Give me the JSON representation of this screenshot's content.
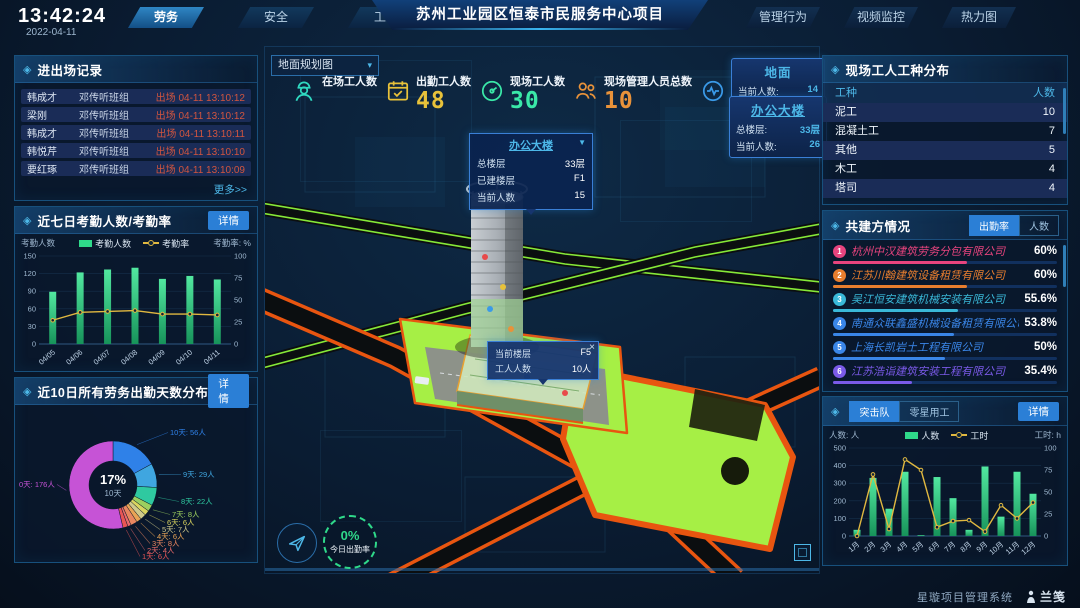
{
  "header": {
    "time": "13:42:24",
    "date": "2022-04-11",
    "tabs_left": [
      {
        "label": "劳务",
        "active": true
      },
      {
        "label": "安全",
        "active": false
      },
      {
        "label": "工期",
        "active": false
      }
    ],
    "title": "苏州工业园区恒泰市民服务中心项目",
    "tabs_right": [
      "管理行为",
      "视频监控",
      "热力图"
    ]
  },
  "entry_exit": {
    "title": "进出场记录",
    "more": "更多>>",
    "rows": [
      {
        "name": "韩成才",
        "team": "邓传听班组",
        "event": "出场 04-11 13:10:12"
      },
      {
        "name": "梁刚",
        "team": "邓传听班组",
        "event": "出场 04-11 13:10:12"
      },
      {
        "name": "韩成才",
        "team": "邓传听班组",
        "event": "出场 04-11 13:10:11"
      },
      {
        "name": "韩悦芹",
        "team": "邓传听班组",
        "event": "出场 04-11 13:10:10"
      },
      {
        "name": "要红琢",
        "team": "邓传听班组",
        "event": "出场 04-11 13:10:09"
      }
    ]
  },
  "panels": {
    "attendance_detail": "详情",
    "distribution_detail": "详情"
  },
  "worker_types": {
    "title": "现场工人工种分布",
    "columns": [
      "工种",
      "人数"
    ],
    "rows": [
      [
        "泥工",
        "10"
      ],
      [
        "混凝土工",
        "7"
      ],
      [
        "其他",
        "5"
      ],
      [
        "木工",
        "4"
      ],
      [
        "塔司",
        "4"
      ]
    ]
  },
  "partners": {
    "title": "共建方情况",
    "tabs": [
      "出勤率",
      "人数"
    ],
    "rows": [
      {
        "rank": "1",
        "name": "杭州中汉建筑劳务分包有限公司",
        "value": "60%",
        "pct": 60,
        "color": "#e8447e"
      },
      {
        "rank": "2",
        "name": "江苏川翰建筑设备租赁有限公司",
        "value": "60%",
        "pct": 60,
        "color": "#e87e2e"
      },
      {
        "rank": "3",
        "name": "吴江恒安建筑机械安装有限公司",
        "value": "55.6%",
        "pct": 55.6,
        "color": "#3ab8d8"
      },
      {
        "rank": "4",
        "name": "南通众联鑫盛机械设备租赁有限公司",
        "value": "53.8%",
        "pct": 53.8,
        "color": "#3a86e8"
      },
      {
        "rank": "5",
        "name": "上海长凯岩土工程有限公司",
        "value": "50%",
        "pct": 50,
        "color": "#3a86e8"
      },
      {
        "rank": "6",
        "name": "江苏浩诣建筑安装工程有限公司",
        "value": "35.4%",
        "pct": 35.4,
        "color": "#7a5ae8"
      }
    ]
  },
  "assault": {
    "tabs": [
      "突击队",
      "零星用工"
    ],
    "detail": "详情"
  },
  "scene": {
    "dropdown": "地面规划图",
    "stats": [
      {
        "icon": "worker-icon",
        "label": "在场工人数",
        "value": "",
        "color": "#2fd9c0"
      },
      {
        "icon": "calendar-icon",
        "label": "出勤工人数",
        "value": "48",
        "color": "#e8c23a"
      },
      {
        "icon": "gauge-icon",
        "label": "现场工人数",
        "value": "30",
        "color": "#3ae8a8"
      },
      {
        "icon": "people-icon",
        "label": "现场管理人员总数",
        "value": "10",
        "color": "#e8923a"
      },
      {
        "icon": "pulse-icon",
        "label": "异常出勤数",
        "value": "0",
        "color": "#3a9ae8"
      }
    ],
    "ground_panel": {
      "title": "地面",
      "rows": [
        {
          "label": "当前人数:",
          "value": "14"
        }
      ]
    },
    "building_panel": {
      "title": "办公大楼",
      "rows": [
        {
          "label": "总楼层:",
          "value": "33层"
        },
        {
          "label": "当前人数:",
          "value": "26"
        }
      ]
    },
    "tower_tooltip": {
      "title": "办公大楼",
      "rows": [
        {
          "label": "总楼层",
          "value": "33层"
        },
        {
          "label": "已建楼层",
          "value": "F1"
        },
        {
          "label": "当前人数",
          "value": "15"
        }
      ]
    },
    "floor_tooltip": {
      "close": "×",
      "rows": [
        {
          "label": "当前楼层",
          "value": "F5"
        },
        {
          "label": "工人人数",
          "value": "10人"
        }
      ]
    },
    "gauge": {
      "value": "0%",
      "label": "今日出勤率"
    }
  },
  "chart_data": [
    {
      "id": "attendance",
      "type": "bar+line",
      "title": "近七日考勤人数/考勤率",
      "categories": [
        "04/05",
        "04/06",
        "04/07",
        "04/08",
        "04/09",
        "04/10",
        "04/11"
      ],
      "series": [
        {
          "name": "考勤人数",
          "type": "bar",
          "axis": "left",
          "color": "#2fd98a",
          "values": [
            89,
            122,
            127,
            130,
            111,
            116,
            110
          ]
        },
        {
          "name": "考勤率",
          "type": "line",
          "axis": "right",
          "color": "#e0b840",
          "values": [
            27,
            36,
            37,
            38,
            34,
            34,
            33
          ]
        }
      ],
      "left_axis": {
        "label": "考勤人数",
        "ticks": [
          0,
          30,
          60,
          90,
          120,
          150
        ]
      },
      "right_axis": {
        "label": "考勤率: %",
        "ticks": [
          0,
          25,
          50,
          75,
          100
        ]
      },
      "grid": true,
      "legend_position": "top"
    },
    {
      "id": "distribution",
      "type": "pie",
      "title": "近10日所有劳务出勤天数分布",
      "center": {
        "pct": "17%",
        "label": "10天"
      },
      "slices": [
        {
          "label": "10天",
          "count": "56人",
          "value": 56,
          "color": "#2f81e8"
        },
        {
          "label": "9天",
          "count": "29人",
          "value": 29,
          "color": "#3fa6e0"
        },
        {
          "label": "8天",
          "count": "22人",
          "value": 22,
          "color": "#2fc9a0"
        },
        {
          "label": "7天",
          "count": "8人",
          "value": 8,
          "color": "#9ccf5f"
        },
        {
          "label": "6天",
          "count": "6人",
          "value": 6,
          "color": "#d9d45f"
        },
        {
          "label": "5天",
          "count": "7人",
          "value": 7,
          "color": "#cfc98a"
        },
        {
          "label": "4天",
          "count": "6人",
          "value": 6,
          "color": "#e8a455"
        },
        {
          "label": "3天",
          "count": "8人",
          "value": 8,
          "color": "#e8865f"
        },
        {
          "label": "2天",
          "count": "4人",
          "value": 4,
          "color": "#e86a6a"
        },
        {
          "label": "1天",
          "count": "6人",
          "value": 6,
          "color": "#e85555"
        },
        {
          "label": "0天",
          "count": "176人",
          "value": 176,
          "color": "#c653d6"
        }
      ]
    },
    {
      "id": "assault",
      "type": "bar+line",
      "title": "突击队",
      "categories": [
        "1月",
        "2月",
        "3月",
        "4月",
        "5月",
        "6月",
        "7月",
        "8月",
        "9月",
        "10月",
        "11月",
        "12月"
      ],
      "series": [
        {
          "name": "人数",
          "type": "bar",
          "axis": "left",
          "color": "#2fd98a",
          "values": [
            35,
            330,
            155,
            365,
            5,
            335,
            215,
            35,
            395,
            110,
            365,
            240
          ]
        },
        {
          "name": "工时",
          "type": "line",
          "axis": "right",
          "color": "#e0b840",
          "values": [
            0,
            70,
            8,
            87,
            75,
            10,
            17,
            18,
            5,
            35,
            20,
            38
          ]
        }
      ],
      "left_axis": {
        "label": "人数: 人",
        "ticks": [
          0,
          100,
          200,
          300,
          400,
          500
        ]
      },
      "right_axis": {
        "label": "工时: h",
        "ticks": [
          0,
          25,
          50,
          75,
          100
        ]
      },
      "grid": true,
      "legend_position": "top"
    }
  ],
  "footer": {
    "system": "星璇项目管理系统",
    "logo": "兰笺"
  }
}
